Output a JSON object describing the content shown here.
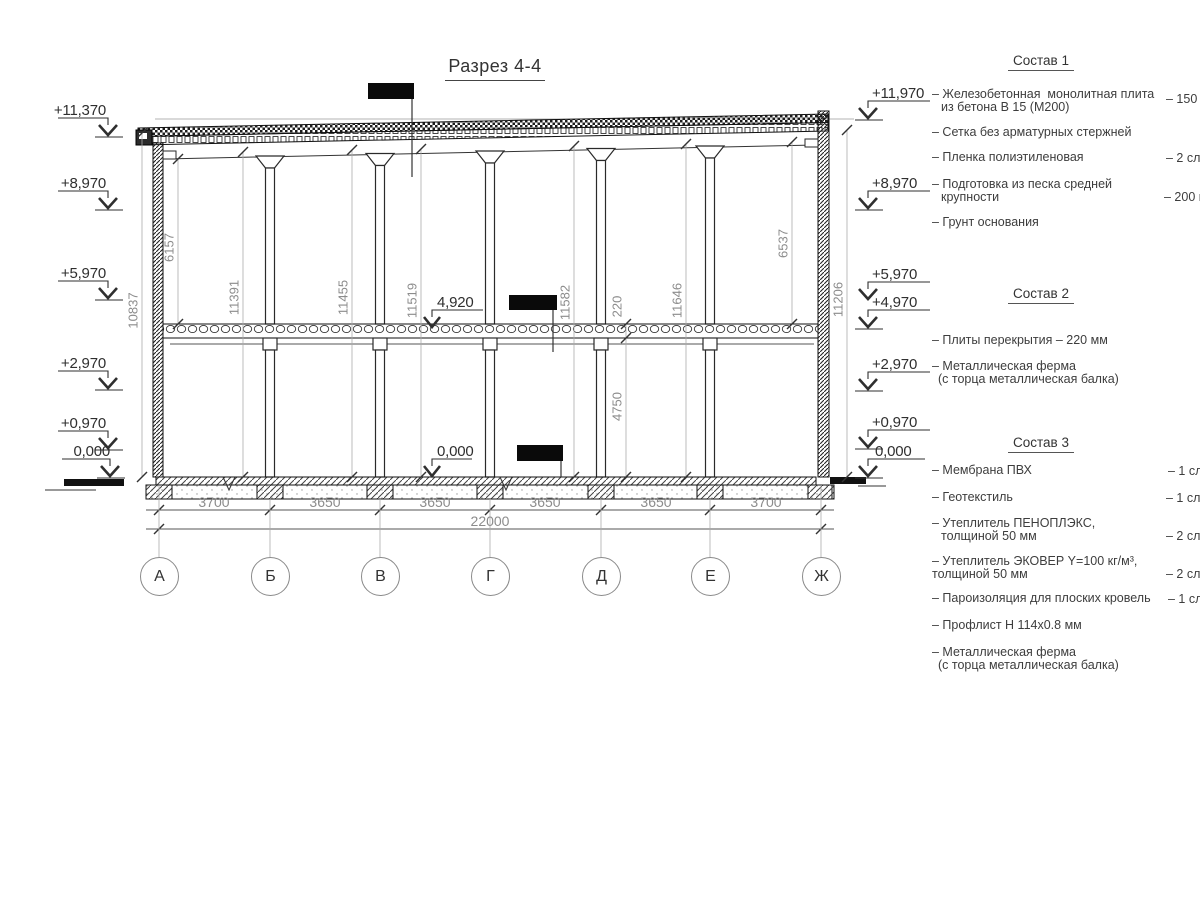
{
  "title": "Разрез 4-4",
  "left_levels": [
    "+11,370",
    "+8,970",
    "+5,970",
    "+2,970",
    "+0,970",
    "0,000"
  ],
  "right_levels": [
    "+11,970",
    "+8,970",
    "+5,970",
    "+4,970",
    "+2,970",
    "+0,970",
    "0,000"
  ],
  "internal_levels": [
    "4,920",
    "0,000"
  ],
  "axes": [
    "А",
    "Б",
    "В",
    "Г",
    "Д",
    "Е",
    "Ж"
  ],
  "bottom_dims": [
    "3700",
    "3650",
    "3650",
    "3650",
    "3650",
    "3700"
  ],
  "total_dim": "22000",
  "vertical_dims": [
    "10837",
    "6157",
    "11391",
    "11455",
    "11519",
    "11582",
    "220",
    "11646",
    "6537",
    "4750",
    "11206"
  ],
  "comp1": {
    "header": "Состав 1",
    "i1a": "– Железобетонная  монолитная плита",
    "i1b": "из бетона В 15 (М200)",
    "v1": "– 150 м",
    "i2": "– Сетка без арматурных стержней",
    "i3": "– Пленка полиэтиленовая",
    "v3": "– 2 сло",
    "i4a": "– Подготовка из песка средней",
    "i4b": "крупности",
    "v4": "– 200 м",
    "i5": "– Грунт основания"
  },
  "comp2": {
    "header": "Состав 2",
    "i1": "– Плиты перекрытия – 220 мм",
    "i2a": "– Металлическая ферма",
    "i2b": "(с торца металлическая балка)"
  },
  "comp3": {
    "header": "Состав 3",
    "i1": "– Мембрана ПВХ",
    "v1": "– 1 сло",
    "i2": "– Геотекстиль",
    "v2": "– 1 сло",
    "i3a": "– Утеплитель ПЕНОПЛЭКС,",
    "i3b": "толщиной 50 мм",
    "v3": "– 2 сло",
    "i4a": "– Утеплитель ЭКОВЕР Y=100 кг/м³,",
    "i4b": "толщиной 50 мм",
    "v4": "– 2 сло",
    "i5": "– Пароизоляция для плоских кровель",
    "v5": "– 1 сло",
    "i6": "– Профлист Н 114х0.8 мм",
    "i7a": "– Металлическая ферма",
    "i7b": "(с торца металлическая балка)"
  }
}
